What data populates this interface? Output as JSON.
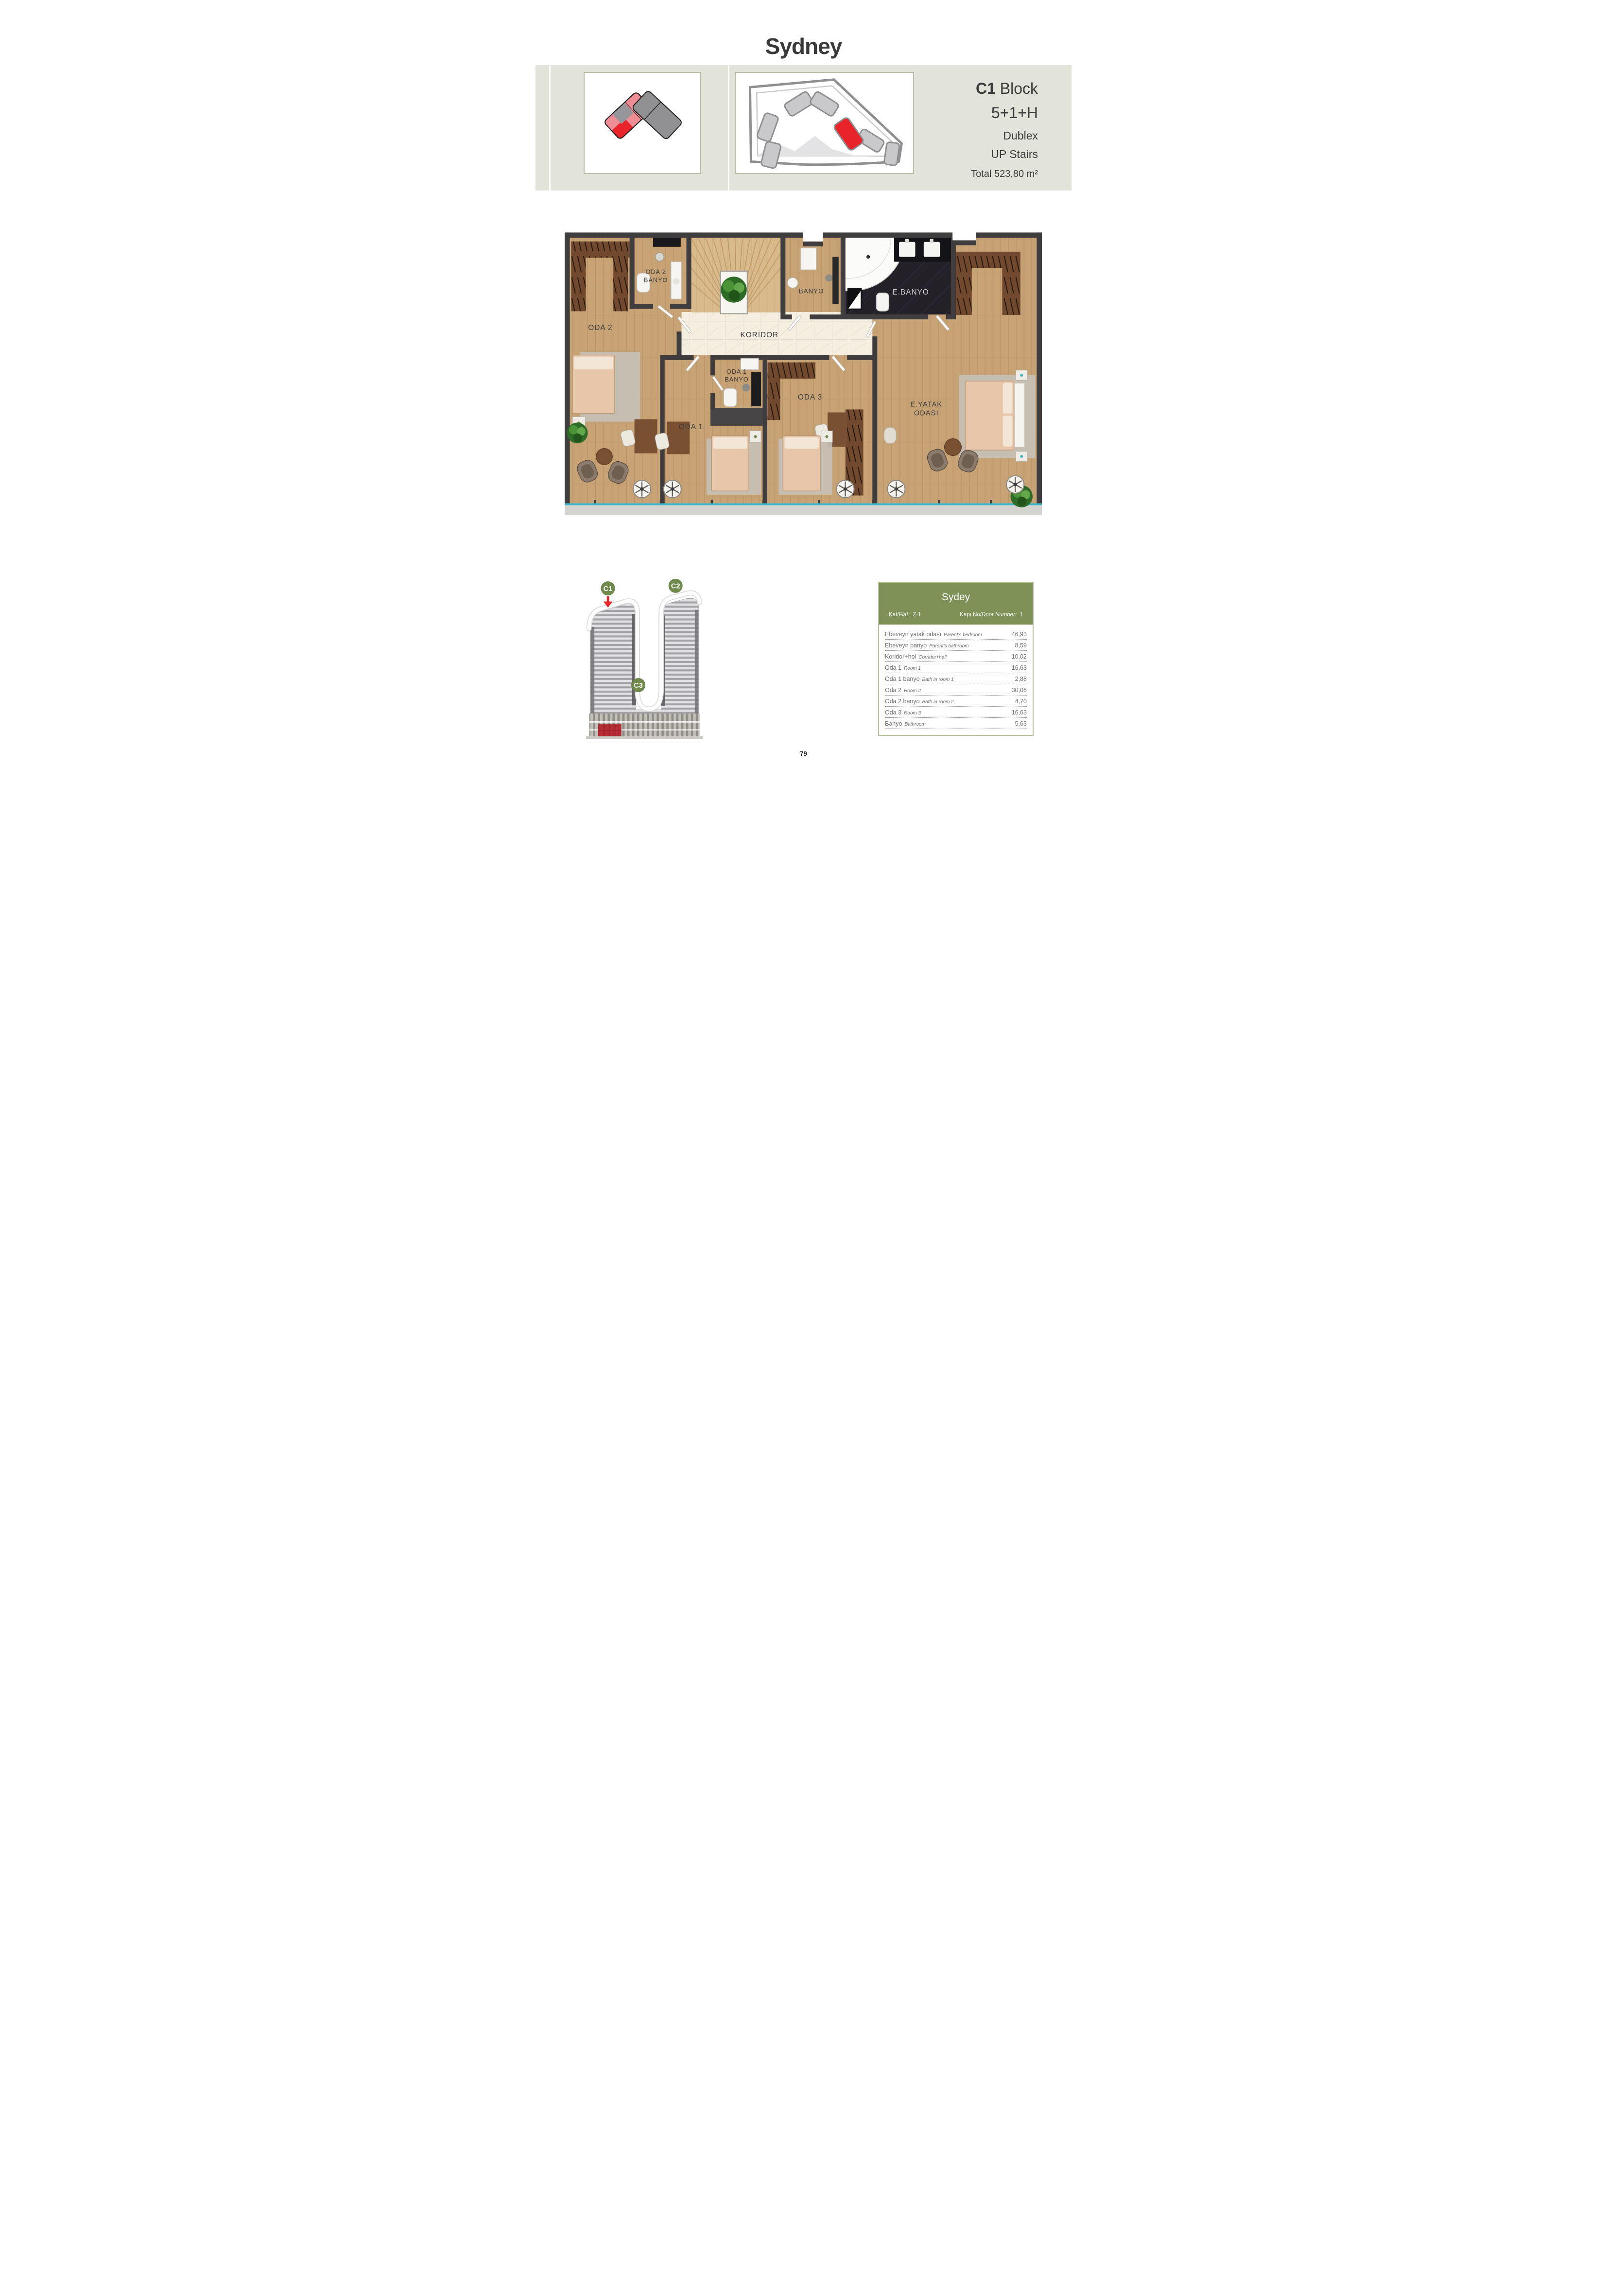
{
  "page": {
    "title": "Sydney",
    "number": "79"
  },
  "header": {
    "block_code": "C1",
    "block_word": "Block",
    "unit_type": "5+1+H",
    "unit_style": "Dublex",
    "unit_floor": "UP Stairs",
    "total_area": "Total 523,80 m²"
  },
  "floorplan": {
    "labels": {
      "oda2": "ODA 2",
      "oda2_banyo_line1": "ODA 2",
      "oda2_banyo_line2": "BANYO",
      "koridor": "KORİDOR",
      "banyo": "BANYO",
      "ebanyo": "E.BANYO",
      "oda1": "ODA 1",
      "oda1_banyo_line1": "ODA 1",
      "oda1_banyo_line2": "BANYO",
      "oda3": "ODA 3",
      "eyatak_line1": "E.YATAK",
      "eyatak_line2": "ODASI"
    }
  },
  "building": {
    "badge_c1": "C1",
    "badge_c2": "C2",
    "badge_c3": "C3"
  },
  "area_table": {
    "title": "Sydey",
    "flat_label_tr": "Kat/",
    "flat_label_en": "Flat:",
    "flat_value": "Z-1",
    "door_label_tr": "Kapı No/",
    "door_label_en": "Door Number:",
    "door_value": "1",
    "rows": [
      {
        "tr": "Ebeveyn yatak odası",
        "en": "Parent's bedroom",
        "value": "46,93"
      },
      {
        "tr": "Ebeveyn banyo",
        "en": "Parent's bathroom",
        "value": "8,59"
      },
      {
        "tr": "Koridor+hol",
        "en": "Corridor+hall",
        "value": "10,02"
      },
      {
        "tr": "Oda 1",
        "en": "Room 1",
        "value": "16,63"
      },
      {
        "tr": "Oda 1 banyo",
        "en": "Bath in room 1",
        "value": "2,88"
      },
      {
        "tr": "Oda 2",
        "en": "Room 2",
        "value": "30,06"
      },
      {
        "tr": "Oda 2 banyo",
        "en": "Bath in room 2",
        "value": "4,70"
      },
      {
        "tr": "Oda 3",
        "en": "Room 3",
        "value": "16,63"
      },
      {
        "tr": "Banyo",
        "en": "Bathroom",
        "value": "5,63"
      }
    ]
  },
  "colors": {
    "accent_green": "#7e9257",
    "badge_green": "#6f8a4a",
    "highlight_red": "#e8232a",
    "band_background": "#e2e4da",
    "wall": "#3f3d3e",
    "wood": "#c6a274",
    "marble": "#f5efe2",
    "dark_bath": "#232127",
    "glass_teal": "#3fb6c7"
  }
}
